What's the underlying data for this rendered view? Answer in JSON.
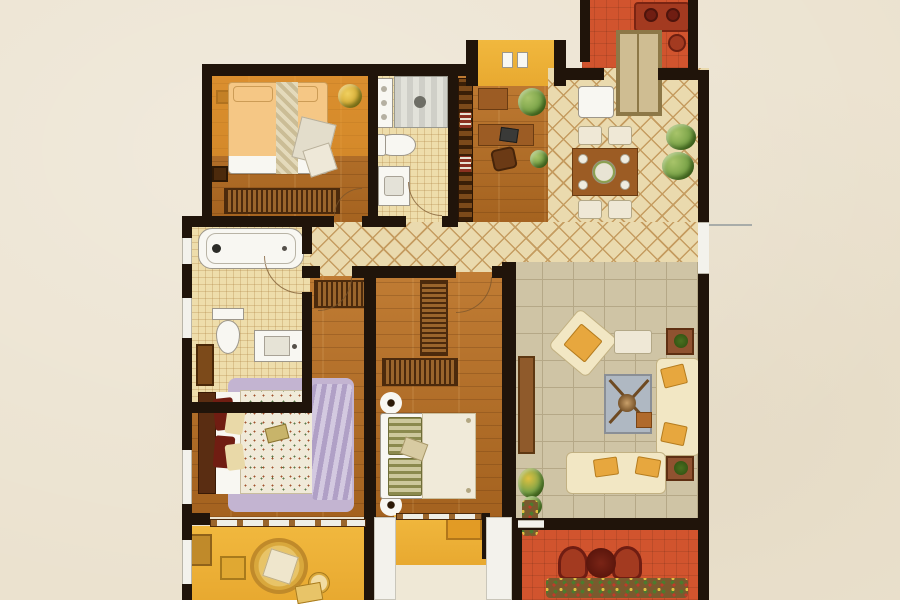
{
  "image": {
    "kind": "apartment floor plan, top-down decorated rendering",
    "text_labels": [],
    "orientation": "three bedrooms left/center, living-dining right, three balconies bottom, one balcony top-right"
  },
  "palette": {
    "bg": "#ebe2cf",
    "wall": "#20140a",
    "wood": "#c07c34",
    "wood_dark": "#a4621f",
    "tile": "#eeddab",
    "diamond": "#eadaae",
    "diamond_line": "#c59c60",
    "stone": "#cfc4a5",
    "stone_line": "#b5a887",
    "shower": "#d9d9d3",
    "yellow": "#f1b83e",
    "orange_hl": "#f2a12c",
    "red": "#d1542e",
    "red_dark": "#a33a20",
    "maroon": "#701d12",
    "fixture": "#f8f7f2",
    "window": "#f3f2ec",
    "cream": "#efe8d6",
    "sofa": "#f2e7c4",
    "cushion": "#e7a73e",
    "rug_purple": "#c3b4d1",
    "throw_purple": "#b0a0c6",
    "quilt": "#f0ead9",
    "rug_blue": "#afb8c2",
    "wardrobe_dark": "#4c2a0c",
    "wardrobe_light": "#9a652c",
    "table_brown": "#9c5c24",
    "door_frame": "#8d7847",
    "frame_fill": "#cfbd92",
    "plant": "#7aa348",
    "plant_dark": "#49701f"
  },
  "rooms": [
    {
      "id": "bedroom-top-left",
      "label": "bedroom with bay highlight",
      "furniture": [
        "double-bed",
        "wardrobe",
        "stool",
        "plant"
      ]
    },
    {
      "id": "bathroom-top",
      "label": "bathroom",
      "furniture": [
        "shower",
        "washer-cabinet",
        "toilet",
        "vanity"
      ]
    },
    {
      "id": "study",
      "label": "study",
      "furniture": [
        "bookshelf",
        "desk",
        "chair",
        "plant"
      ]
    },
    {
      "id": "balcony-top-right",
      "label": "entry balcony",
      "furniture": [
        "bench",
        "pot",
        "entry-door"
      ]
    },
    {
      "id": "dining",
      "label": "dining room",
      "furniture": [
        "table",
        "four-chairs",
        "fridge",
        "plants"
      ]
    },
    {
      "id": "bathroom-left",
      "label": "main bathroom",
      "furniture": [
        "bathtub",
        "toilet",
        "vanity"
      ]
    },
    {
      "id": "hallway",
      "label": "hallway",
      "furniture": []
    },
    {
      "id": "bedroom-left",
      "label": "master bedroom",
      "furniture": [
        "double-bed",
        "purple-rug",
        "wardrobe",
        "dresser"
      ]
    },
    {
      "id": "bedroom-middle",
      "label": "bedroom",
      "furniture": [
        "double-bed",
        "two-wardrobes",
        "nightstand-lamps"
      ]
    },
    {
      "id": "living",
      "label": "living room",
      "furniture": [
        "two-sofas",
        "armchair",
        "coffee-table-rug",
        "tv-cabinet",
        "side-tables",
        "plants"
      ]
    },
    {
      "id": "balcony-bottom-left",
      "label": "leisure balcony",
      "furniture": [
        "papasan-chair",
        "small-tables",
        "rug"
      ]
    },
    {
      "id": "balcony-bottom-middle",
      "label": "service balcony",
      "furniture": [
        "cabinet"
      ]
    },
    {
      "id": "balcony-bottom-right",
      "label": "terrace",
      "furniture": [
        "two-chairs",
        "round-table",
        "flower-bed"
      ]
    }
  ]
}
